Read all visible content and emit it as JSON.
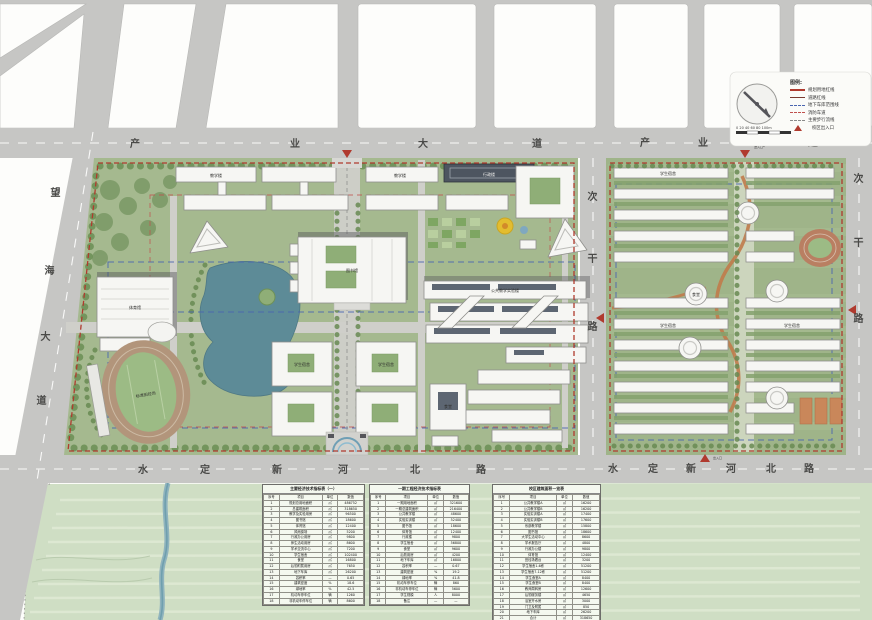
{
  "colors": {
    "road_gray": "#c6c6c4",
    "campus_green": "#a5b98f",
    "field_green": "#cfdec4",
    "lake_teal": "#5d8b97",
    "boundary_red": "#b03a2e",
    "garage_blue": "#4a66b0"
  },
  "roads": {
    "chanye": "产业大道",
    "shuiding": "水定新河北路",
    "wanghai": "望海大道",
    "cigan": "次干路"
  },
  "gates": {
    "label": "出入口"
  },
  "legend": {
    "title": "图例:",
    "items": [
      {
        "label": "规划用地红线",
        "swatch": "solid-red"
      },
      {
        "label": "道路红线",
        "swatch": "solid-darkred"
      },
      {
        "label": "地下车库范围线",
        "swatch": "dash-blue"
      },
      {
        "label": "消防车道",
        "swatch": "dash-red"
      },
      {
        "label": "主要步行流线",
        "swatch": "dash-gray"
      },
      {
        "label": "校区出入口",
        "swatch": "triangle-red"
      }
    ],
    "scale_ticks": "0  20  40  60  80  100m"
  },
  "buildings": {
    "library": "图书馆",
    "gym": "体育馆",
    "stadium": "标准田径场",
    "teaching": "教学楼",
    "labs": "公共教学实验楼",
    "admin": "行政楼",
    "dorm": "学生宿舍",
    "canteen": "食堂"
  },
  "tables": [
    {
      "title": "主要经济技术指标表（一）",
      "columns": [
        "序号",
        "项目",
        "单位",
        "数值"
      ],
      "rows": [
        [
          "1",
          "规划总用地面积",
          "㎡",
          "486752"
        ],
        [
          "2",
          "总建筑面积",
          "㎡",
          "318650"
        ],
        [
          "3",
          "教学及实验用房",
          "㎡",
          "96500"
        ],
        [
          "4",
          "图书馆",
          "㎡",
          "18600"
        ],
        [
          "5",
          "体育馆",
          "㎡",
          "12400"
        ],
        [
          "6",
          "风雨操场",
          "㎡",
          "5200"
        ],
        [
          "7",
          "行政办公用房",
          "㎡",
          "9800"
        ],
        [
          "8",
          "师生活动用房",
          "㎡",
          "8600"
        ],
        [
          "9",
          "学术交流中心",
          "㎡",
          "7200"
        ],
        [
          "10",
          "学生宿舍",
          "㎡",
          "102400"
        ],
        [
          "11",
          "食堂",
          "㎡",
          "16800"
        ],
        [
          "12",
          "后勤附属用房",
          "㎡",
          "7650"
        ],
        [
          "13",
          "地下车库",
          "㎡",
          "26200"
        ],
        [
          "14",
          "容积率",
          "—",
          "0.65"
        ],
        [
          "15",
          "建筑密度",
          "%",
          "18.6"
        ],
        [
          "16",
          "绿地率",
          "%",
          "42.5"
        ],
        [
          "17",
          "机动车停车位",
          "辆",
          "1260"
        ],
        [
          "18",
          "非机动车停车位",
          "辆",
          "8600"
        ]
      ]
    },
    {
      "title": "一期工程经济技术指标表",
      "columns": [
        "序号",
        "项目",
        "单位",
        "数值"
      ],
      "rows": [
        [
          "1",
          "一期用地面积",
          "㎡",
          "321600"
        ],
        [
          "2",
          "一期总建筑面积",
          "㎡",
          "216400"
        ],
        [
          "3",
          "公共教学楼",
          "㎡",
          "48600"
        ],
        [
          "4",
          "实验实训楼",
          "㎡",
          "52400"
        ],
        [
          "5",
          "图书馆",
          "㎡",
          "18600"
        ],
        [
          "6",
          "体育馆",
          "㎡",
          "12400"
        ],
        [
          "7",
          "行政楼",
          "㎡",
          "9800"
        ],
        [
          "8",
          "学生宿舍",
          "㎡",
          "56800"
        ],
        [
          "9",
          "食堂",
          "㎡",
          "9600"
        ],
        [
          "10",
          "后勤用房",
          "㎡",
          "4200"
        ],
        [
          "11",
          "地下车库",
          "㎡",
          "16800"
        ],
        [
          "12",
          "容积率",
          "—",
          "0.67"
        ],
        [
          "13",
          "建筑密度",
          "%",
          "19.2"
        ],
        [
          "14",
          "绿地率",
          "%",
          "41.8"
        ],
        [
          "15",
          "机动车停车位",
          "辆",
          "860"
        ],
        [
          "16",
          "非机动车停车位",
          "辆",
          "5600"
        ],
        [
          "17",
          "学生规模",
          "人",
          "8000"
        ],
        [
          "18",
          "备注",
          "—",
          "—"
        ]
      ]
    },
    {
      "title": "校区建筑面积一览表",
      "columns": [
        "序号",
        "项目",
        "单位",
        "数值"
      ],
      "rows": [
        [
          "1",
          "公共教学楼A",
          "㎡",
          "16200"
        ],
        [
          "2",
          "公共教学楼B",
          "㎡",
          "16200"
        ],
        [
          "3",
          "实验实训楼A",
          "㎡",
          "17400"
        ],
        [
          "4",
          "实验实训楼B",
          "㎡",
          "17600"
        ],
        [
          "5",
          "系部教学楼",
          "㎡",
          "15800"
        ],
        [
          "6",
          "图书馆",
          "㎡",
          "18600"
        ],
        [
          "7",
          "大学生活动中心",
          "㎡",
          "8600"
        ],
        [
          "8",
          "学术报告厅",
          "㎡",
          "4800"
        ],
        [
          "9",
          "行政办公楼",
          "㎡",
          "9800"
        ],
        [
          "10",
          "体育馆",
          "㎡",
          "12400"
        ],
        [
          "11",
          "田径场看台",
          "㎡",
          "3200"
        ],
        [
          "12",
          "学生宿舍1-6栋",
          "㎡",
          "51200"
        ],
        [
          "13",
          "学生宿舍7-12栋",
          "㎡",
          "51200"
        ],
        [
          "14",
          "学生食堂A",
          "㎡",
          "8400"
        ],
        [
          "15",
          "学生食堂B",
          "㎡",
          "8400"
        ],
        [
          "16",
          "教师周转房",
          "㎡",
          "12600"
        ],
        [
          "17",
          "后勤服务楼",
          "㎡",
          "4650"
        ],
        [
          "18",
          "浴室开水房",
          "㎡",
          "3000"
        ],
        [
          "19",
          "门卫及附属",
          "㎡",
          "850"
        ],
        [
          "20",
          "地下车库",
          "㎡",
          "26200"
        ],
        [
          "21",
          "合计",
          "㎡",
          "318650"
        ],
        [
          "22",
          "",
          "",
          ""
        ]
      ]
    }
  ]
}
